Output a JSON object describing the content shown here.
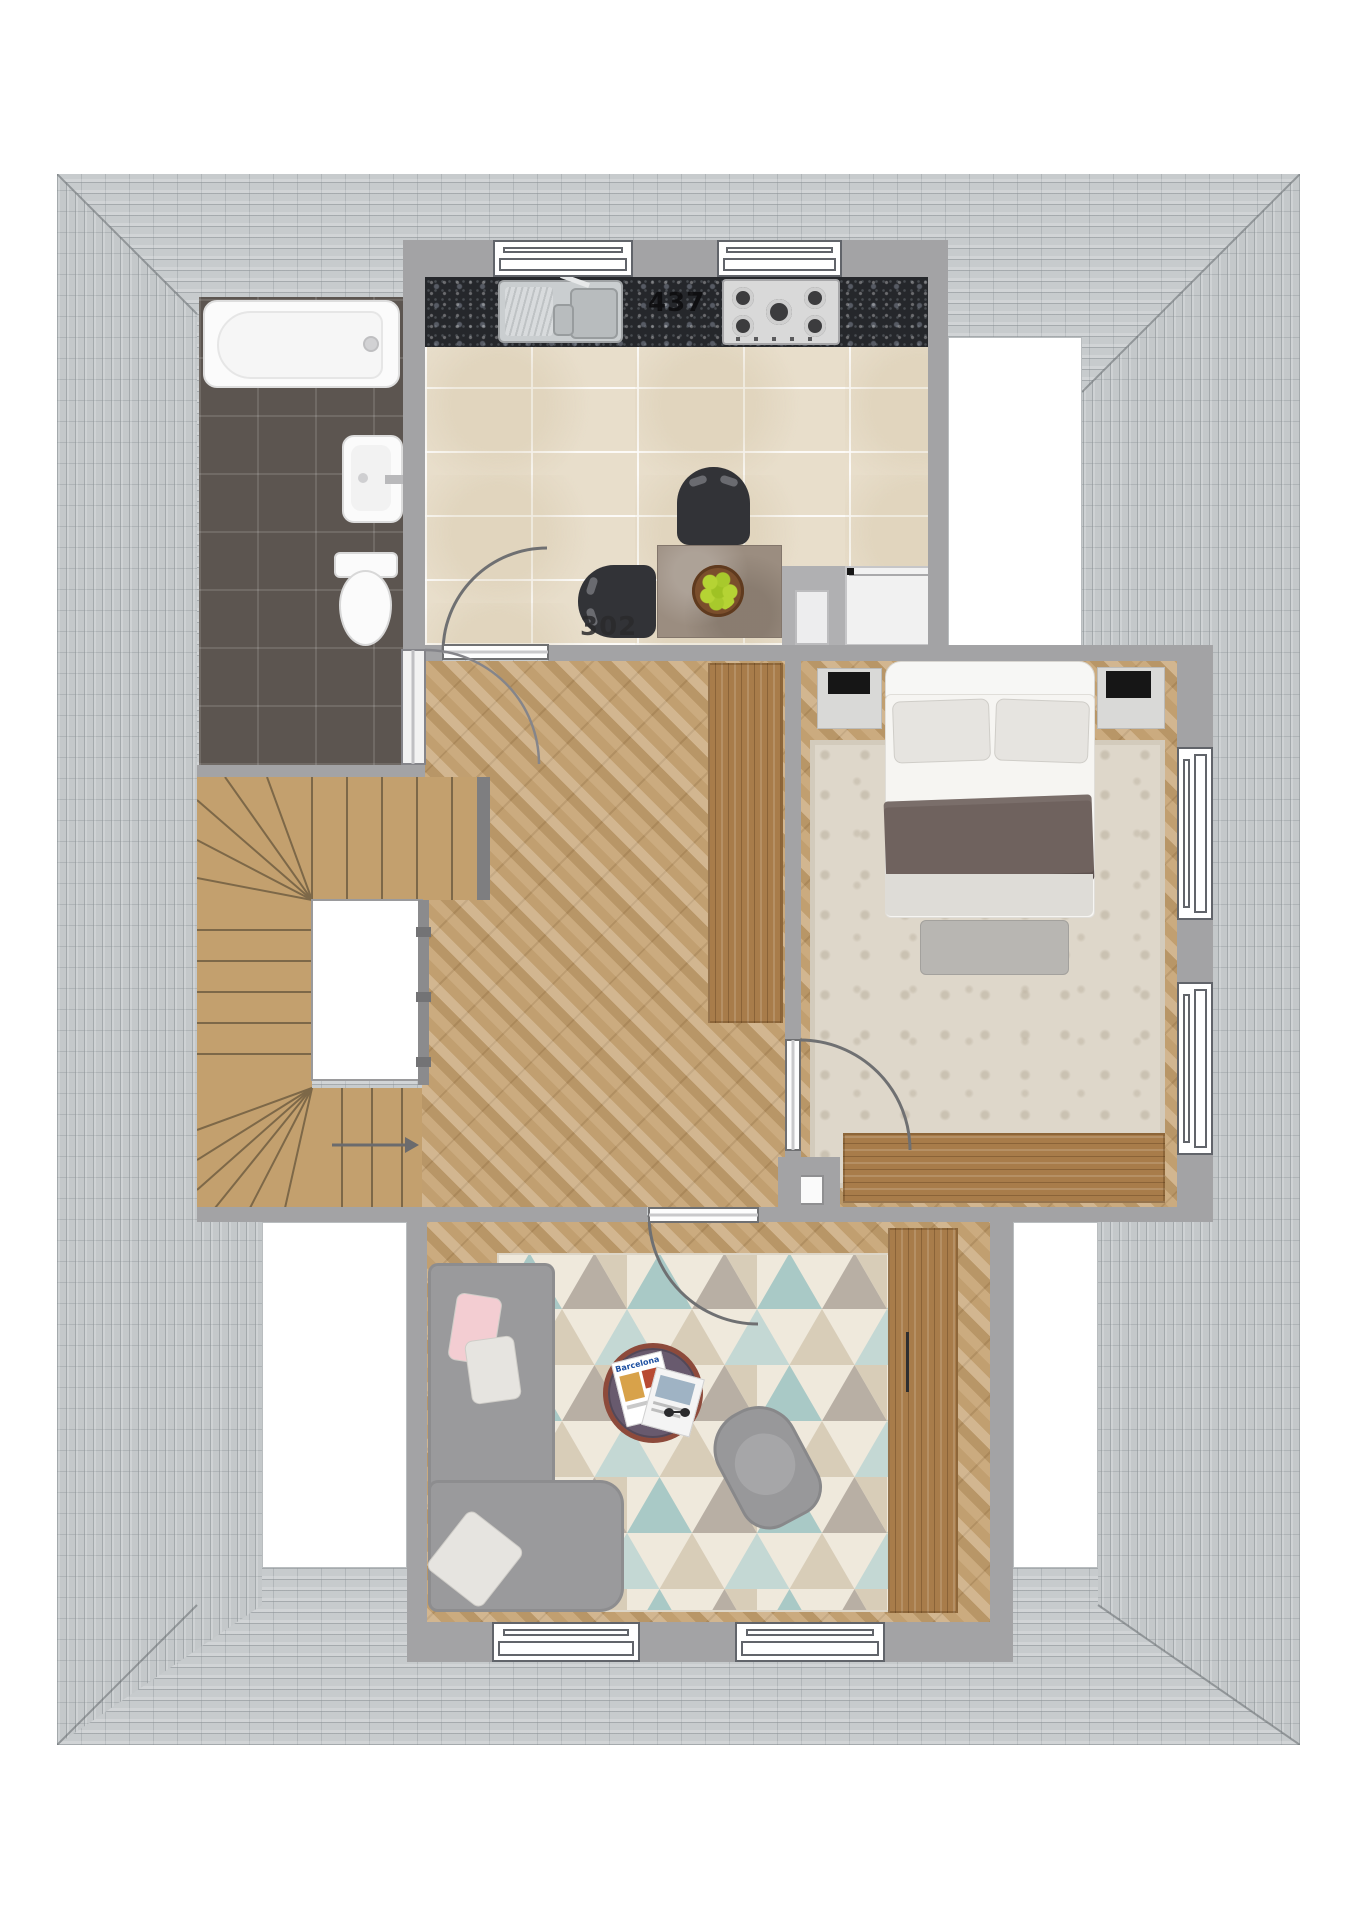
{
  "floor_plan": {
    "annotations": {
      "counter_code": "437",
      "floor_code": "302",
      "magazine_title": "Barcelona"
    },
    "palette": {
      "roof_slate": "#c7cbcd",
      "wall_gray": "#a3a3a5",
      "granite_counter": "#25272b",
      "kitchen_tile": "#e8decb",
      "bathroom_tile": "#5c5550",
      "parquet_oak": "#c7a474",
      "furniture_wood": "#a87c4a",
      "sofa_gray": "#9a9a9c",
      "rug_teal": "#a9c9c6",
      "rug_cream": "#efe9dc",
      "rug_taupe": "#b8afa4",
      "rug_sand": "#d8cdb8",
      "pink_cushion": "#f3cdd2",
      "apple_green": "#b5d334",
      "coffee_table_rim": "#8d4a3b",
      "coffee_table_top": "#685a6e"
    },
    "rooms": {
      "bathroom": {
        "fixtures": [
          "bathtub",
          "washbasin",
          "toilet"
        ]
      },
      "kitchen": {
        "fixtures": [
          "granite-counter",
          "double-sink",
          "gas-hob",
          "fridge",
          "appliance",
          "dining-table",
          "fruit-bowl",
          "chair",
          "chair",
          "window",
          "window",
          "door"
        ]
      },
      "hallway": {
        "fixtures": [
          "staircase",
          "stairwell",
          "railing",
          "wardrobe"
        ]
      },
      "bedroom": {
        "fixtures": [
          "double-bed",
          "pillow",
          "pillow",
          "throw-blanket",
          "nightstand",
          "nightstand",
          "area-rug",
          "bench",
          "dresser",
          "window",
          "window",
          "door"
        ]
      },
      "living_room": {
        "fixtures": [
          "corner-sofa",
          "cushions",
          "coffee-table",
          "magazines",
          "sunglasses",
          "armchair",
          "triangle-rug",
          "sideboard",
          "window",
          "window",
          "door"
        ]
      }
    }
  }
}
